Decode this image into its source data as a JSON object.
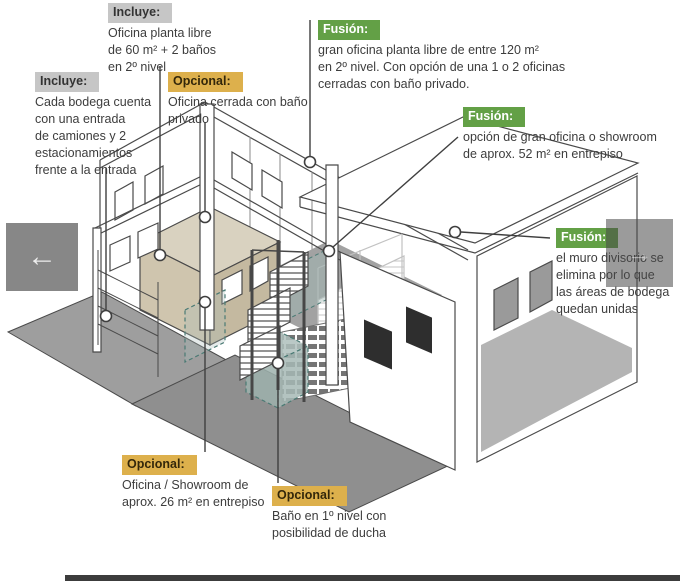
{
  "nav": {
    "back_arrow": "←",
    "forward_arrow": "→"
  },
  "colors": {
    "incluye_header_bg": "#c6c6c6",
    "opcional_header_bg": "#ddb04c",
    "fusion_header_bg": "#63a046",
    "fusion_header_text": "#ffffff",
    "body_text": "#3d3d3d",
    "drawing_line": "#4a4a4a",
    "office_volume_tan": "#cfc5ae",
    "bath_volume_teal": "#a9bfbb",
    "floor_dark_gray": "#8f8f8f",
    "apron_gray": "#9e9e9e",
    "nav_button_gray": "#878787"
  },
  "annotations": [
    {
      "id": "incluye-top",
      "header": "Incluye:",
      "text": "Oficina planta libre\nde 60 m² + 2 baños\nen 2º nivel"
    },
    {
      "id": "incluye-left",
      "header": "Incluye:",
      "text": "Cada bodega cuenta\ncon una entrada\nde camiones y 2\nestacionamientos\nfrente a la entrada"
    },
    {
      "id": "opcional-oficina-cerrada",
      "header": "Opcional:",
      "text": "Oficina cerrada con baño\nprivado"
    },
    {
      "id": "fusion-gran-oficina",
      "header": "Fusión:",
      "text": "gran oficina planta libre de entre 120 m²\nen 2º nivel. Con opción de una 1 o 2 oficinas\ncerradas con baño privado."
    },
    {
      "id": "fusion-showroom",
      "header": "Fusión:",
      "text": "opción de gran oficina o showroom\nde aprox. 52 m² en entrepiso"
    },
    {
      "id": "fusion-muro",
      "header": "Fusión:",
      "text": "el muro divisorio se\nelimina por lo que\nlas áreas de bodega\nquedan unidas"
    },
    {
      "id": "opcional-showroom",
      "header": "Opcional:",
      "text": "Oficina / Showroom de\naprox. 26 m² en entrepiso"
    },
    {
      "id": "opcional-bano",
      "header": "Opcional:",
      "text": "Baño en 1º nivel con\nposibilidad de ducha"
    }
  ]
}
